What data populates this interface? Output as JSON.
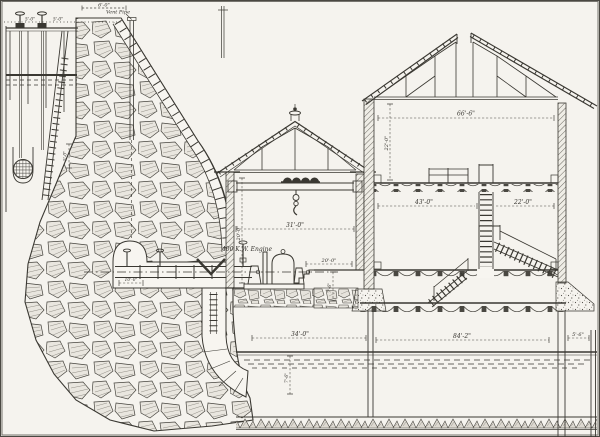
{
  "drawing": {
    "colors": {
      "paper": "#f5f3ee",
      "margin": "#e9e7e2",
      "ink": "#3a3832",
      "stone_fill": "#e9e6df",
      "hatch": "#8f8c84"
    },
    "labels": {
      "vent_pipe": "Vent Pipe",
      "engine": "400 K.W. Engine"
    },
    "dims": {
      "crest": "6'-0\"",
      "gate_a": "5'-0\"",
      "gate_b": "5'-0\"",
      "intake": "5'-0\"",
      "gallery": "10'-0\"",
      "engine_span": "31'-0\"",
      "engine_height": "20'-0\"",
      "basement_span": "20'-0\"",
      "basement_height": "7'-6\"",
      "mill_span": "66'-6\"",
      "mill_height": "22'-0\"",
      "bay_left": "43'-0\"",
      "bay_right": "22'-0\"",
      "tail_left": "34'-0\"",
      "tail_main": "84'-2\"",
      "tail_right": "5'-6\"",
      "tail_depth": "7'-6\""
    }
  }
}
